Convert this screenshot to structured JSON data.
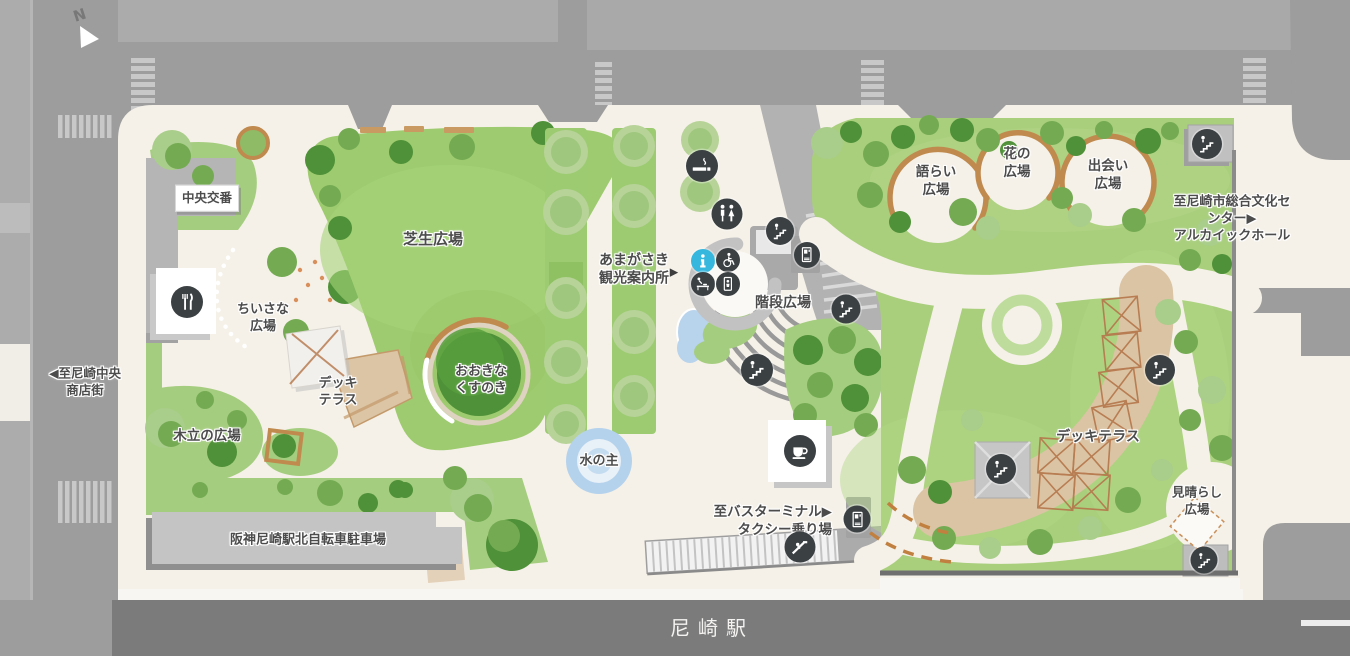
{
  "compass": {
    "north_letter": "N"
  },
  "station": {
    "name": "尼崎駅"
  },
  "areas": {
    "police_box": "中央交番",
    "lawn_plaza": "芝生広場",
    "small_plaza": "ちいさな\n広場",
    "deck_terrace_left": "デッキ\nテラス",
    "big_camphor_tree": "おおきな\nくすのき",
    "grove_plaza": "木立の広場",
    "bicycle_parking": "阪神尼崎駅北自転車駐車場",
    "water_feature": "水の主",
    "tourist_information": "あまがさき\n観光案内所",
    "tourist_information_arrow": "▶",
    "stairs_plaza": "階段広場",
    "katarai_plaza": "語らい\n広場",
    "flower_plaza": "花の\n広場",
    "deai_plaza": "出会い\n広場",
    "deck_terrace_right": "デッキテラス",
    "lookout_plaza": "見晴らし\n広場"
  },
  "directions": {
    "to_culture_center": "至尼崎市総合文化センター▶\nアルカイックホール",
    "to_bus_terminal": "至バスターミナル▶\nタクシー乗り場",
    "to_shopping_street": "◀至尼崎中央\n商店街"
  },
  "map_icons": {
    "restaurant": "restaurant-icon",
    "cafe": "cafe-icon",
    "smoking_area": "smoking-area-icon",
    "restroom": "restroom-icon",
    "information": "information-icon",
    "wheelchair_accessible": "wheelchair-icon",
    "baby_changing": "baby-changing-icon",
    "baby_keep": "baby-keep-icon",
    "stairs": "stairs-icon",
    "escalator": "escalator-icon",
    "vending_machine": "vending-machine-icon"
  },
  "colors": {
    "road": "#9d9d9d",
    "building_block": "#ababab",
    "park_ground": "#f5f1e8",
    "lawn_green": "#9ecb6f",
    "tree_dark": "#4f9138",
    "tree_mid": "#74ab52",
    "tree_pale": "#a9cd8a",
    "path_brown": "#c08a4e",
    "deck_tan": "#dbc4a4",
    "water_blue": "#b5d2ec",
    "info_blue": "#35b7de",
    "icon_dark": "#3b4043",
    "station_band": "#7b7b7b",
    "label_text": "#4c4c4c"
  }
}
